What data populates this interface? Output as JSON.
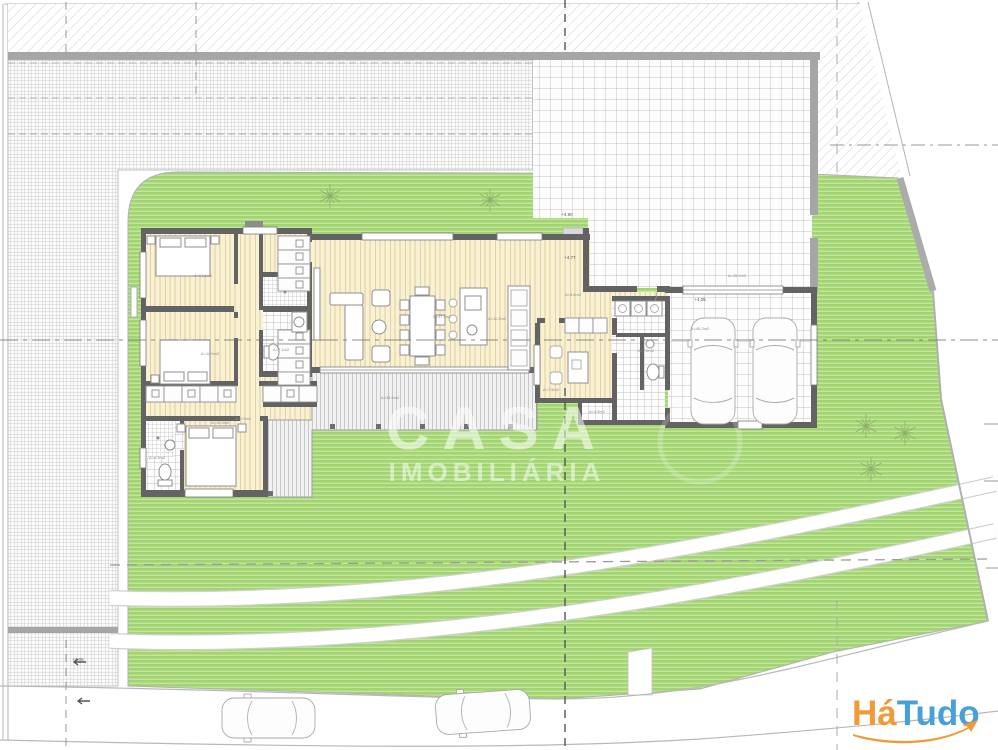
{
  "watermark": {
    "line1": "CASA",
    "line2": "IMOBILIÁRIA",
    "color": "#ffffff"
  },
  "logo": {
    "part1": "Há",
    "part2": "Tudo",
    "color_part1": "#f09a38",
    "color_part2": "#47a0d9",
    "swoosh_color": "#f09a38"
  },
  "colors": {
    "lawn_base": "#a2d572",
    "lawn_stripe": "#c3e59c",
    "wood_base": "#f8f1d4",
    "wood_stripe": "#e2d098",
    "wall_dark": "#636363",
    "site_wall": "#a6a6a6",
    "tile_line": "#adadad",
    "hatch_line": "#bcbcbc",
    "deck_line": "#9e9e9e"
  },
  "plan": {
    "room_labels": [
      {
        "x": 203,
        "y": 277,
        "text": "A=14.5m2"
      },
      {
        "x": 210,
        "y": 355,
        "text": "A=14.5m2"
      },
      {
        "x": 281,
        "y": 351,
        "text": "A=7.1m2"
      },
      {
        "x": 157,
        "y": 459,
        "text": "A=4.3m2"
      },
      {
        "x": 220,
        "y": 424,
        "text": "A=10.9m2"
      },
      {
        "x": 243,
        "y": 420,
        "text": "A=0.5m2"
      },
      {
        "x": 442,
        "y": 318,
        "text": "A=47.5m2"
      },
      {
        "x": 497,
        "y": 320,
        "text": "A=11.3m2"
      },
      {
        "x": 390,
        "y": 399,
        "text": "A=34.5m2"
      },
      {
        "x": 551,
        "y": 391,
        "text": "A=7.5m2"
      },
      {
        "x": 597,
        "y": 413,
        "text": "A=4.5m2"
      },
      {
        "x": 646,
        "y": 352,
        "text": "A=2.6m2"
      },
      {
        "x": 737,
        "y": 277,
        "text": "A=45.6m2"
      },
      {
        "x": 700,
        "y": 330,
        "text": "A=40.2m2"
      },
      {
        "x": 573,
        "y": 296,
        "text": "A=9.8m2"
      }
    ],
    "level_marks": [
      {
        "x": 570,
        "y": 259,
        "text": "+4.77"
      },
      {
        "x": 700,
        "y": 301,
        "text": "+4.05"
      },
      {
        "x": 567,
        "y": 216,
        "text": "+4.90"
      },
      {
        "x": 78,
        "y": 661,
        "text": "+4.05"
      }
    ],
    "plants": [
      {
        "x": 330,
        "y": 196
      },
      {
        "x": 490,
        "y": 200
      },
      {
        "x": 866,
        "y": 426
      },
      {
        "x": 905,
        "y": 433
      },
      {
        "x": 871,
        "y": 469
      }
    ]
  }
}
